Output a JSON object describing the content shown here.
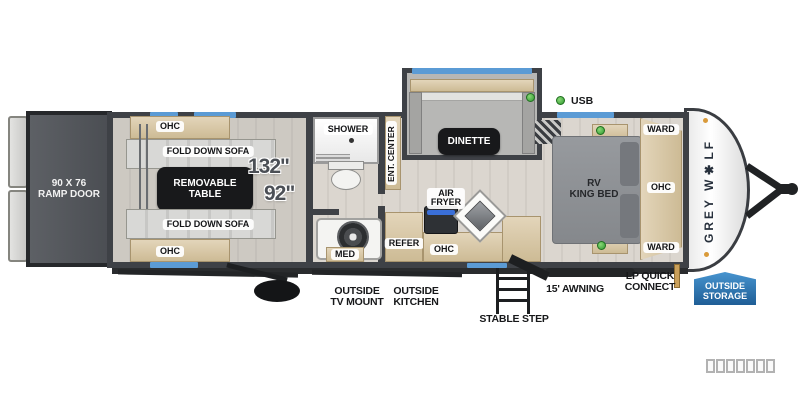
{
  "brand": {
    "logo_text": "GREY W✱LF",
    "logo_color": "#27303c"
  },
  "colors": {
    "wall_gray": "#3e4146",
    "window_blue": "#5b9bd5",
    "indicator_green": "#3cae3c",
    "counter_tan": "#d9c8a7",
    "storage_badge_blue": "#2f7fc1"
  },
  "labels": {
    "ramp_door": "90 X 76\nRAMP DOOR",
    "ohc_garage_top": "OHC",
    "sofa_top": "FOLD DOWN SOFA",
    "table": "REMOVABLE\nTABLE",
    "sofa_bottom": "FOLD DOWN SOFA",
    "ohc_garage_bottom": "OHC",
    "dim_main": "132\"",
    "dim_secondary": "92\"",
    "shower": "SHOWER",
    "med": "MED",
    "ent_center": "ENT. CENTER",
    "dinette": "DINETTE",
    "air_fryer": "AIR\nFRYER",
    "refer": "REFER",
    "ohc_kitchen": "OHC",
    "usb": "USB",
    "bed": "RV\nKING BED",
    "ward_top": "WARD",
    "ohc_bedroom": "OHC",
    "ward_bottom": "WARD",
    "outside_tv_mount": "OUTSIDE\nTV MOUNT",
    "outside_kitchen": "OUTSIDE\nKITCHEN",
    "stable_step": "STABLE STEP",
    "awning": "15' AWNING",
    "lp_quick_connect": "LP QUICK\nCONNECT",
    "outside_storage": "OUTSIDE\nSTORAGE"
  }
}
